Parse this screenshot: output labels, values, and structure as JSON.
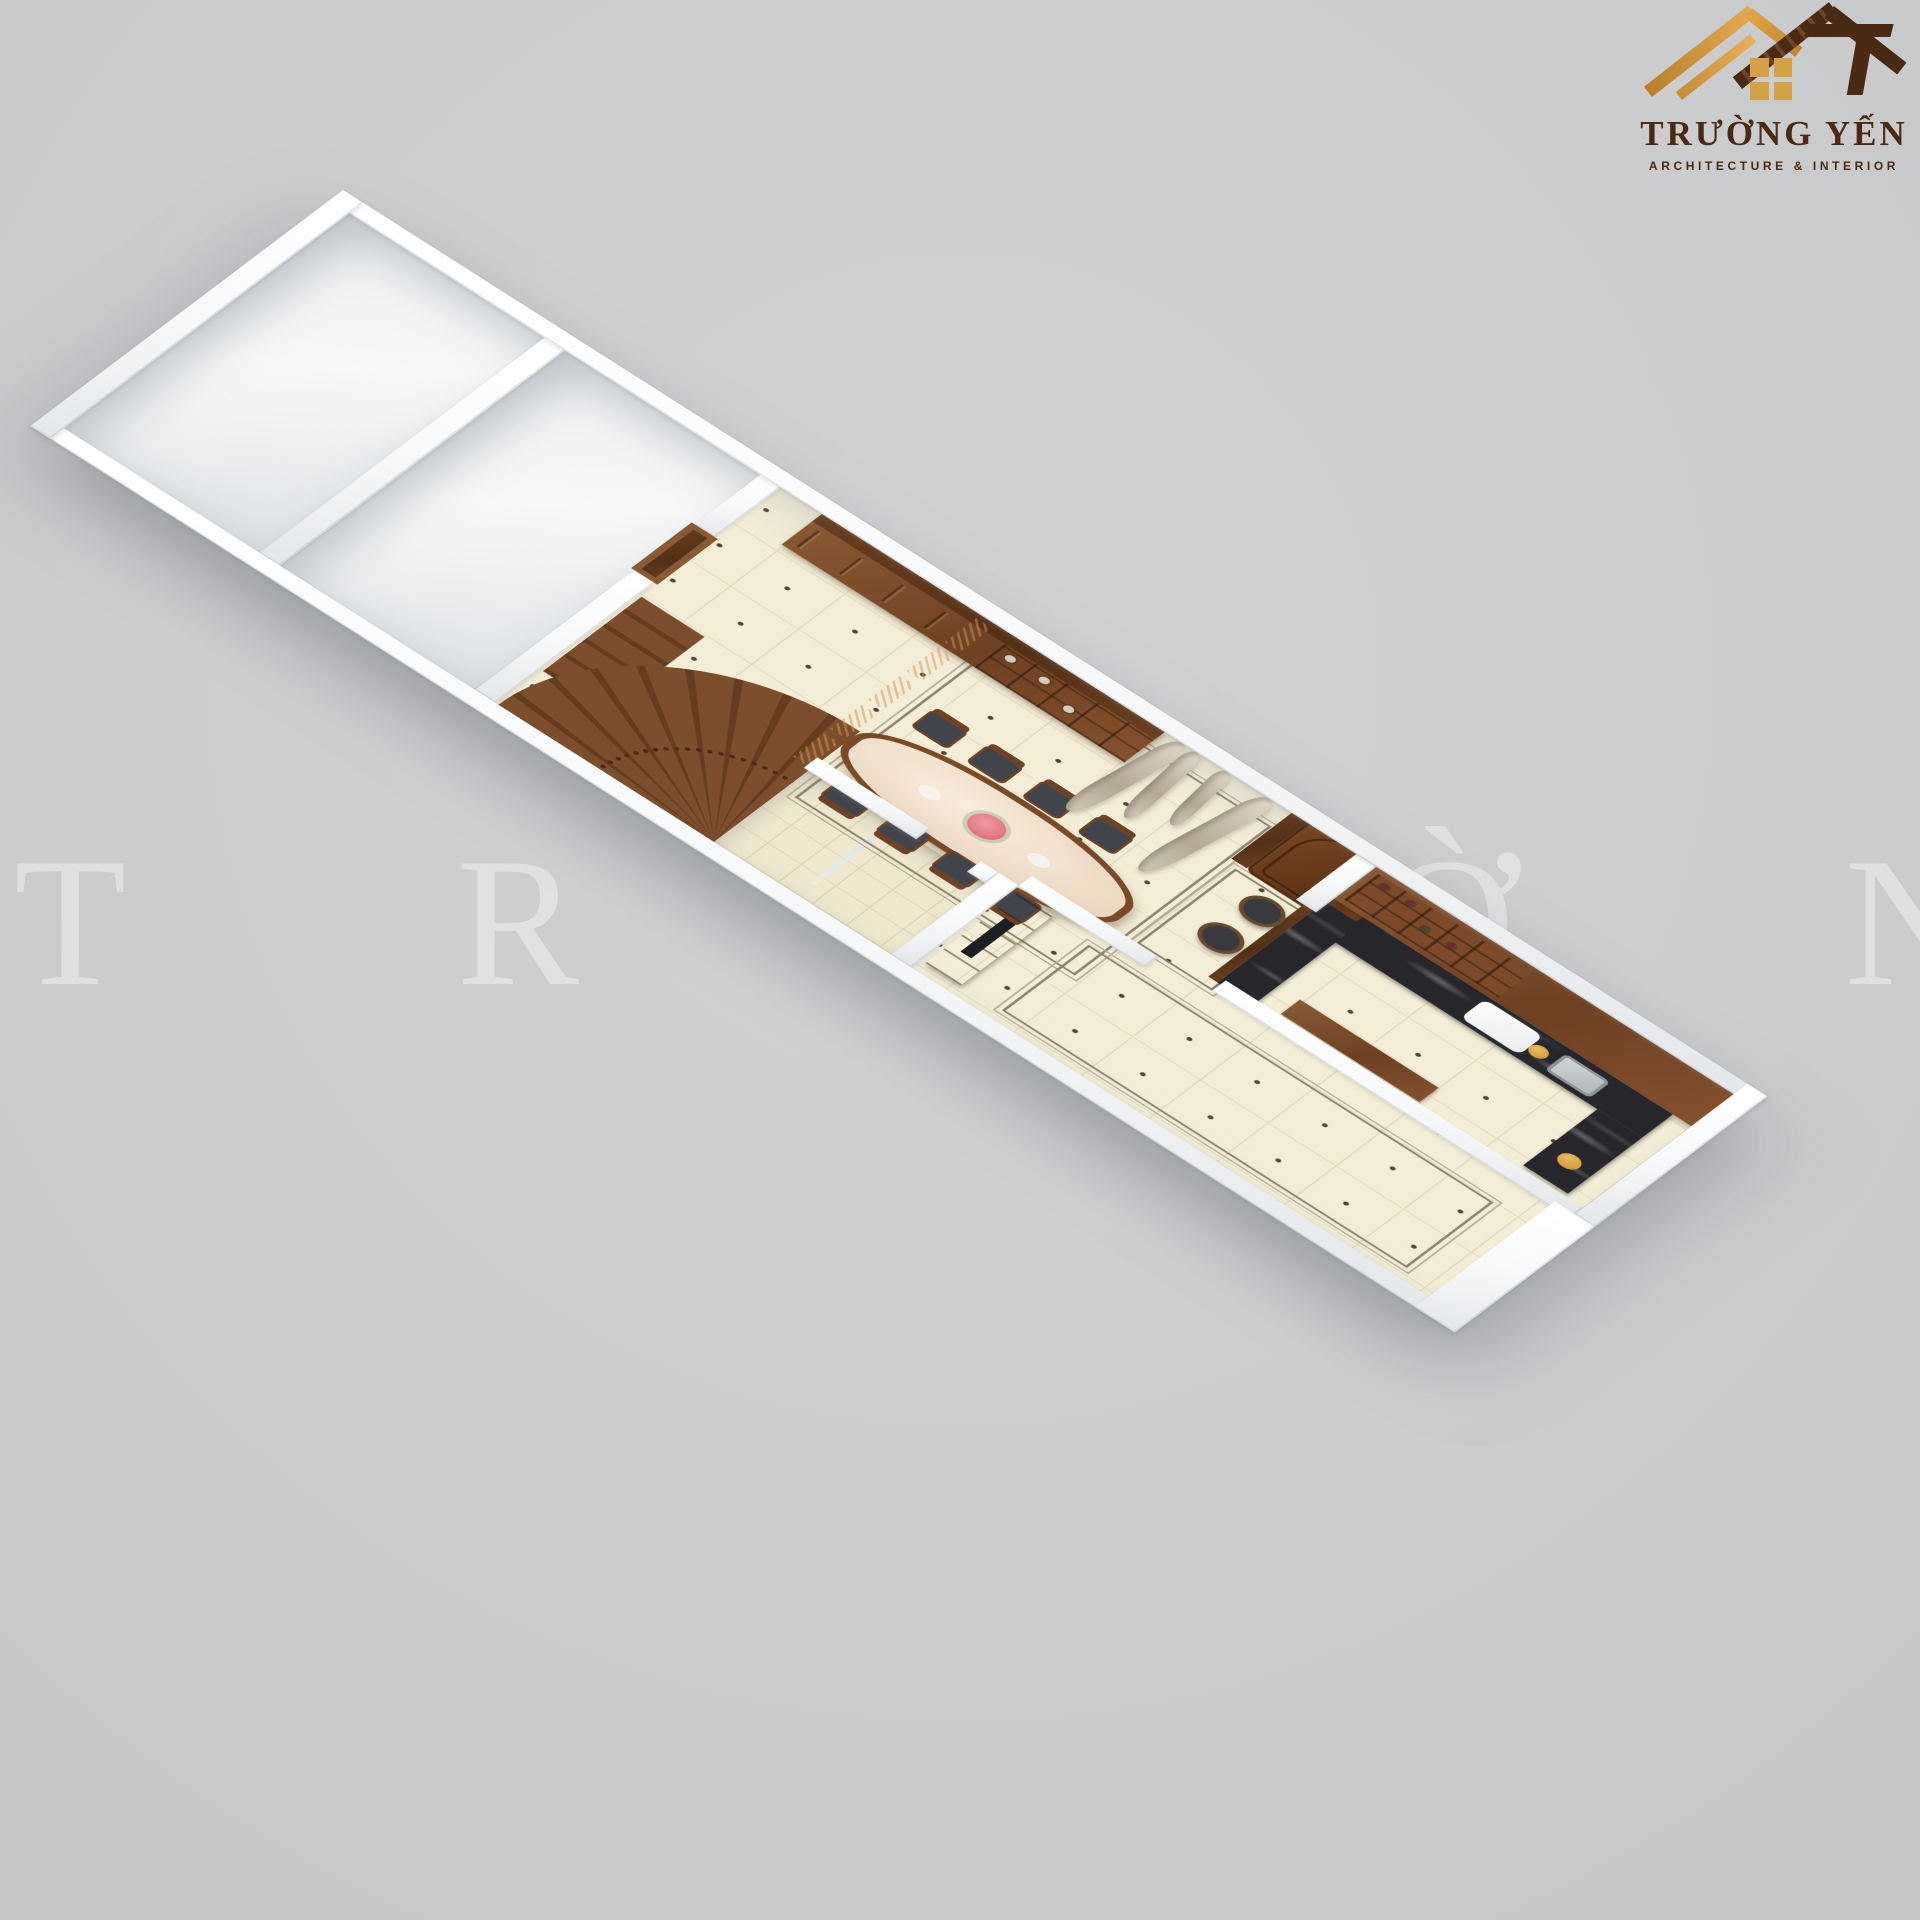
{
  "brand": {
    "name": "TRƯỜNG YẾN",
    "tagline": "ARCHITECTURE & INTERIOR",
    "gold": "#D39A3E",
    "brown": "#4A2B15"
  },
  "watermark": {
    "text": "TRƯỜNG YẾN"
  },
  "scene": {
    "type": "3d-floor-plan-render",
    "background_color": "#CBCCCE",
    "palette": {
      "wall": "#FFFFFF",
      "wall_shade": "#E4E7EA",
      "floor_tile": "#F4EED6",
      "tile_line": "#E5DCBF",
      "wood": "#7C4E2B",
      "wood_dark": "#5E3A20",
      "marble_black": "#27272B",
      "curtain_beige": "#CEC3B0",
      "table_marble": "#F2E6D8",
      "bathroom_tile": "#EFE8CF"
    },
    "rooms": [
      {
        "id": "storage-room-1",
        "label": "empty room (west end)"
      },
      {
        "id": "storage-room-2",
        "label": "empty room with window"
      },
      {
        "id": "stair-hall",
        "label": "hall with curved wooden staircase"
      },
      {
        "id": "dining-room",
        "label": "dining room"
      },
      {
        "id": "foyer",
        "label": "entry foyer with arched double door"
      },
      {
        "id": "kitchen",
        "label": "kitchen with black marble U-counter"
      },
      {
        "id": "bathroom",
        "label": "bathroom with glass shower"
      },
      {
        "id": "living-room",
        "label": "living room with TV cabinet"
      }
    ],
    "furniture": [
      "display cabinet with vases",
      "carved wood partition screen",
      "oval marble dining table",
      "8 dining chairs",
      "flower centerpiece",
      "two window curtains",
      "arched wooden entry door",
      "curved staircase",
      "wine shelf cabinet",
      "black marble counter & bar",
      "2 bar stools",
      "sink",
      "gold plates",
      "white appliance",
      "wooden sideboard",
      "TV cabinet with TV",
      "floor border inlays"
    ]
  }
}
